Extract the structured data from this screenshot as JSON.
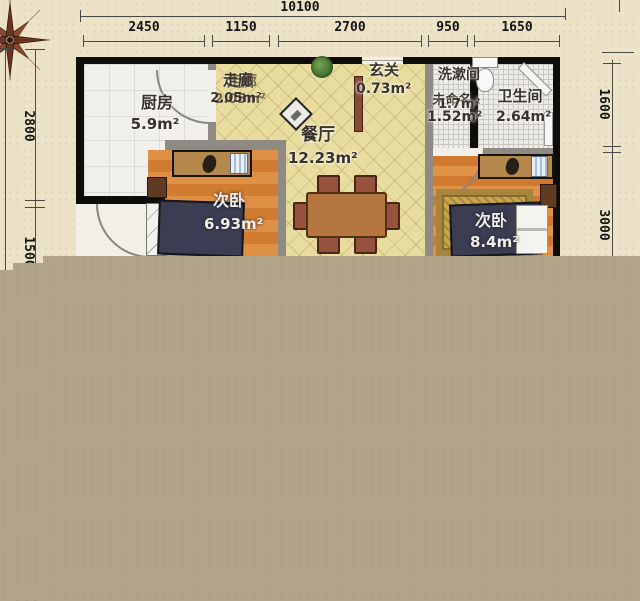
{
  "dimensions": {
    "top_total": "10100",
    "top_segments": [
      "2450",
      "1150",
      "2700",
      "950",
      "1650"
    ],
    "left_segments": [
      "2800",
      "1500"
    ],
    "right_segments": [
      "1600",
      "3000"
    ]
  },
  "rooms": {
    "kitchen": {
      "name": "厨房",
      "area": "5.9m²"
    },
    "corridor": {
      "name": "走廊",
      "area": "2.05m²"
    },
    "entry": {
      "name": "玄关",
      "area": "0.73m²"
    },
    "washroom": {
      "name": "洗漱间",
      "area": "1.52m²",
      "overlay_name": "未命名",
      "overlay_area": "1.7m²"
    },
    "bathroom": {
      "name": "卫生间",
      "area": "2.64m²"
    },
    "dining": {
      "name": "餐厅",
      "area": "12.23m²"
    },
    "bedroom_left": {
      "name": "次卧",
      "area": "6.93m²"
    },
    "bedroom_right": {
      "name": "次卧",
      "area": "8.4m²"
    }
  },
  "colors": {
    "paper": "#ece3c9",
    "cutoff_block": "#b1a488",
    "wall": "#0e0d0b",
    "partition": "#8f8a83",
    "tile_floor": "#e8dc9e",
    "wood_floor": "#d07c31",
    "bed": "#3b3d52",
    "compass": "#6b3322"
  }
}
